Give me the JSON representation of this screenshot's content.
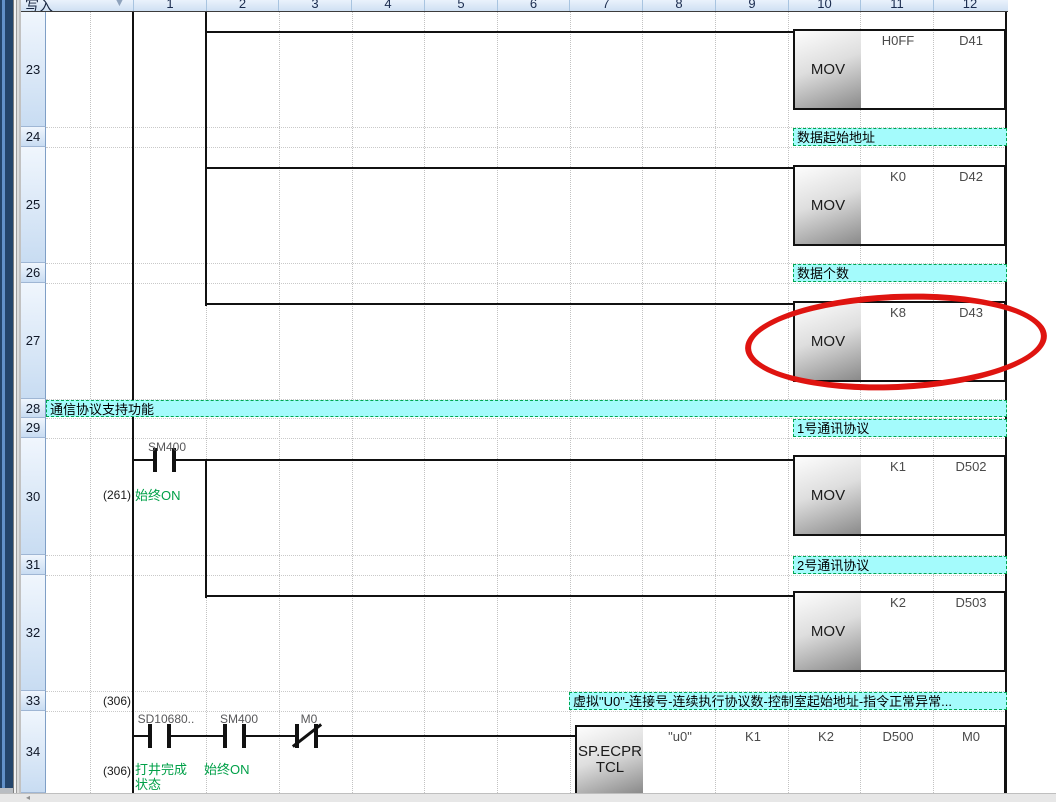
{
  "window": {
    "mode_label": "写入",
    "dropdown_icon": "▼",
    "scroll_left_icon": "◂"
  },
  "header": {
    "columns": [
      "1",
      "2",
      "3",
      "4",
      "5",
      "6",
      "7",
      "8",
      "9",
      "10",
      "11",
      "12"
    ]
  },
  "gutter": {
    "rows": [
      "23",
      "24",
      "25",
      "26",
      "27",
      "28",
      "29",
      "30",
      "31",
      "32",
      "33",
      "34"
    ]
  },
  "comments": {
    "row24": "数据起始地址",
    "row26": "数据个数",
    "row28": "通信协议支持功能",
    "row29": "1号通讯协议",
    "row31": "2号通讯协议",
    "row33": "虚拟\"U0\"-连接号-连续执行协议数-控制室起始地址-指令正常异常..."
  },
  "instructions": {
    "r23": {
      "mnemonic": "MOV",
      "src": "H0FF",
      "dest": "D41"
    },
    "r25": {
      "mnemonic": "MOV",
      "src": "K0",
      "dest": "D42"
    },
    "r27": {
      "mnemonic": "MOV",
      "src": "K8",
      "dest": "D43"
    },
    "r30": {
      "mnemonic": "MOV",
      "src": "K1",
      "dest": "D502"
    },
    "r32": {
      "mnemonic": "MOV",
      "src": "K2",
      "dest": "D503"
    },
    "r34": {
      "mnemonic_line1": "SP.ECPR",
      "mnemonic_line2": "TCL",
      "op1": "\"u0\"",
      "op2": "K1",
      "op3": "K2",
      "op4": "D500",
      "op5": "M0"
    }
  },
  "contacts": {
    "r30_sm400": "SM400",
    "r34_sd10680": "SD10680..",
    "r34_sm400": "SM400",
    "r34_m0": "M0"
  },
  "steps": {
    "r30": "(261)",
    "r33": "(306)",
    "r34": "(306)"
  },
  "device_notes": {
    "r30_sm400": "始终ON",
    "r34_sd10680_line1": "打井完成",
    "r34_sd10680_line2": "状态",
    "r34_sm400": "始终ON"
  },
  "colors": {
    "comment_bg": "#a4fbfc",
    "comment_border": "#00a651",
    "note_green": "#00a048",
    "highlight_red": "#df1410",
    "header_text": "#1b2c4f"
  }
}
